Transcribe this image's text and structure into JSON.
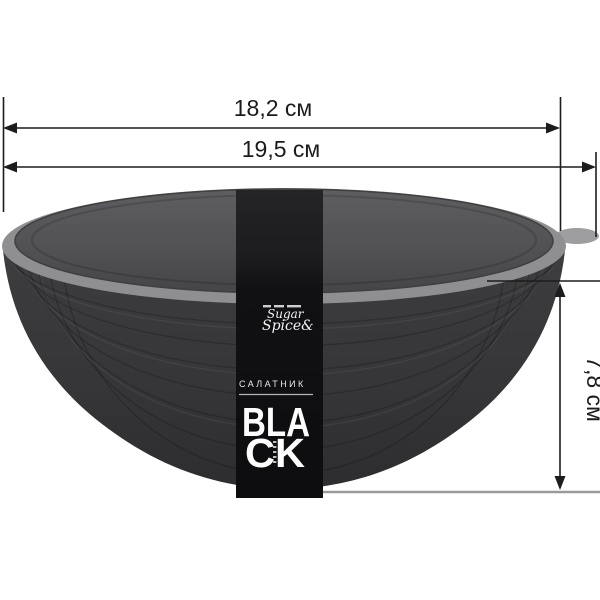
{
  "dimensions": {
    "top_diameter_label": "18,2 см",
    "outer_diameter_label": "19,5 см",
    "height_label": "7,8 см"
  },
  "label_band": {
    "brand_line1": "Sugar",
    "brand_line2": "Spice&",
    "category": "САЛАТНИК",
    "product_name_line1": "BLA",
    "product_name_line2": "CK",
    "product_name": "BLACK"
  },
  "colors": {
    "background": "#ffffff",
    "lid_top": "#565658",
    "rim": "#8f8f91",
    "lid_tab": "#9e9ea0",
    "bowl_body": "#39393b",
    "band": "#111113",
    "dimension_line": "#1c1c1c",
    "baseline_gray": "#9a9a9a",
    "band_text": "#fdfdfd"
  }
}
